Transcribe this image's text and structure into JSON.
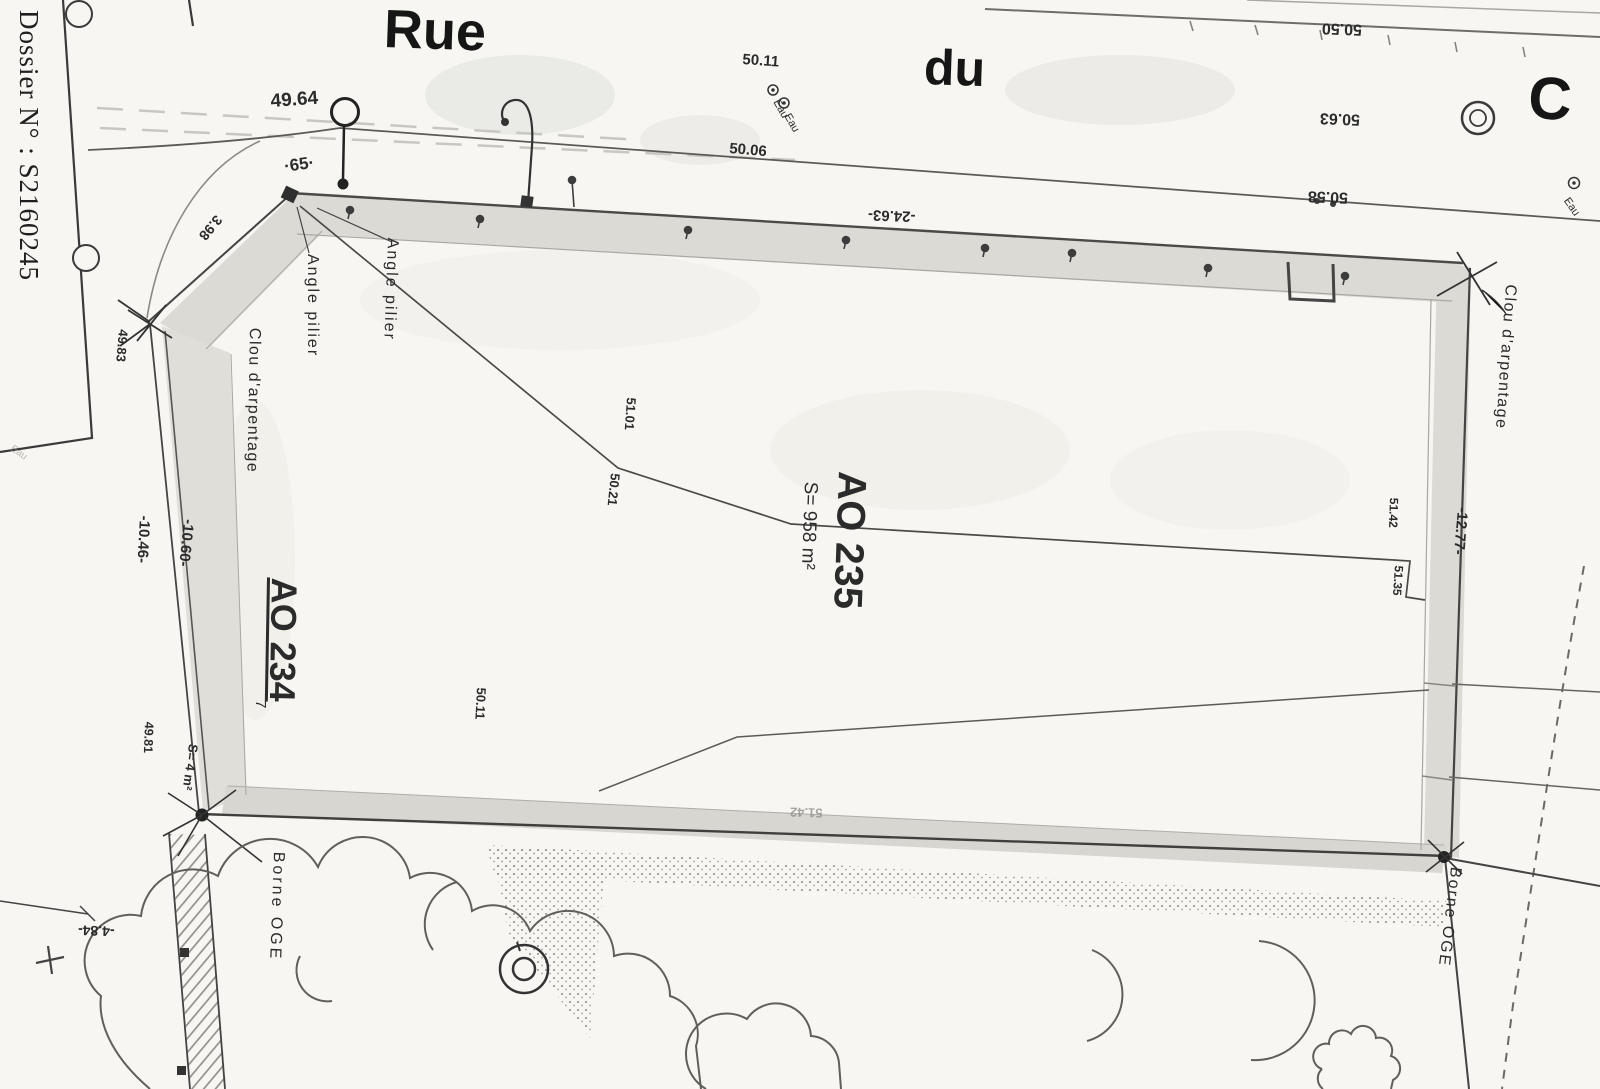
{
  "page": {
    "dossier_number": "Dossier N° : S2160245",
    "paper_color": "#f7f6f2",
    "ink_color": "#2b2b2b",
    "wall_fill": "#dcdad5"
  },
  "street": {
    "name_left": "Rue",
    "name_right": "du",
    "big_letter_right": "C",
    "water_label": "Eau",
    "spot_height_left": "49.64",
    "spot_height_mid_upper": "50.11",
    "spot_height_mid_lower": "50.06",
    "spot_height_right_top": "50.50",
    "spot_height_right_mid": "50.63",
    "spot_height_right_bottom": "50.58",
    "wall_length_top": "-24.63-"
  },
  "parcel_ao235": {
    "id": "AO 235",
    "area": "S= 958 m²",
    "spot_height_terrace_upper": "51.01",
    "spot_height_terrace_lower": "50.21",
    "spot_height_east_upper": "51.42",
    "spot_height_east_lower": "51.35",
    "spot_height_south": "50.11",
    "spot_height_wall_faint": "51.42"
  },
  "parcel_ao234": {
    "id": "AO 234",
    "index_mark": "7",
    "area": "S= 4 m²",
    "dim_outer": "-10.46-",
    "dim_inner": "-10.60-",
    "dim_diagonal": "3.98",
    "dim_south": "-4.84-",
    "spot_height_corner": "49.83",
    "spot_height_mid": "49.81",
    "corner_point": "·65·"
  },
  "east_boundary": {
    "dim": "-12.77-"
  },
  "marks": {
    "angle_pilier": "Angle pilier",
    "clou_arpentage": "Clou d'arpentage",
    "borne_oge": "Borne OGE"
  }
}
